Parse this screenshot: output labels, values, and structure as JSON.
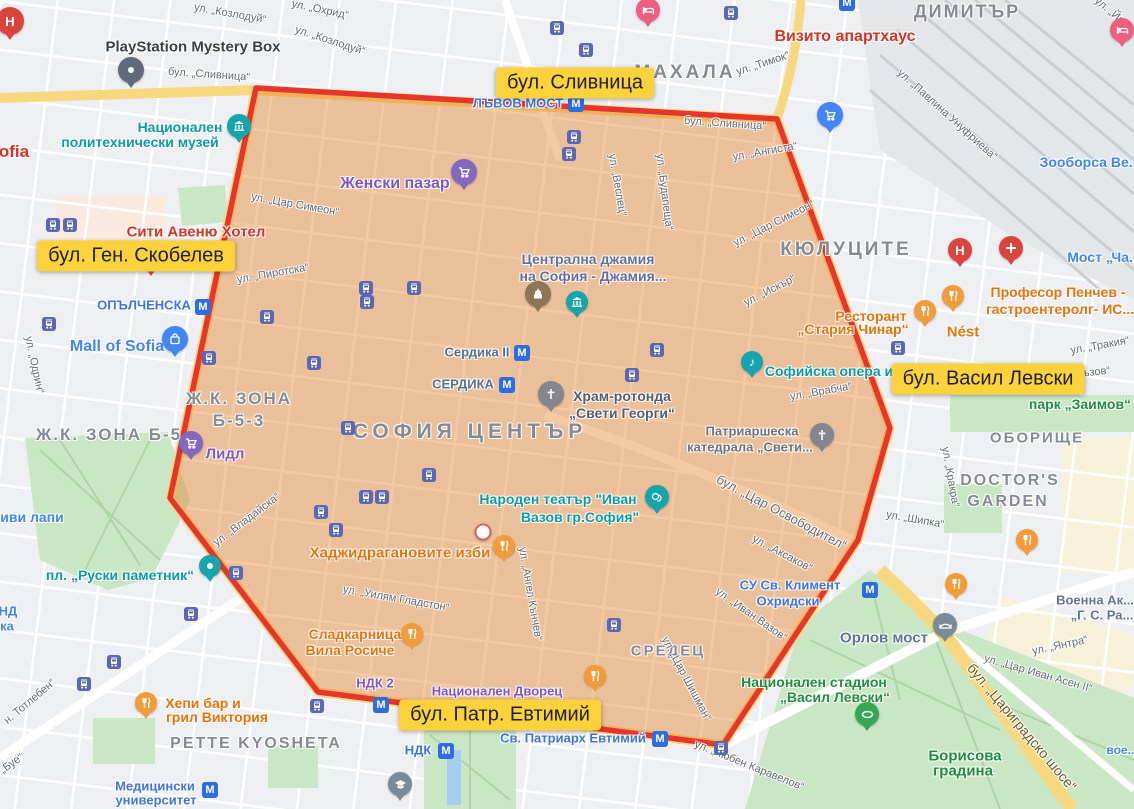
{
  "map": {
    "width": 1134,
    "height": 809
  },
  "colors": {
    "base": "#edeff2",
    "road_white": "#ffffff",
    "road_yellow": "#f8d87f",
    "park": "#c9e7c4",
    "park_path": "#aed3a8",
    "railway_bg": "#e4e7ea",
    "railway_line": "#c9ced4",
    "zone_fill": "#e67e22",
    "zone_fill_opacity": 0.42,
    "zone_stroke": "#e5352c",
    "highlight_bg": "#fbd23c",
    "teal": "#0d9aa3",
    "transit_blue": "#3f74e0",
    "poi_blue": "#4285f4",
    "purple": "#7e57c2",
    "mosque_text": "#646e9c",
    "orange_food": "#e8710a",
    "red_poi": "#d93025",
    "green_park_text": "#1e8e3e",
    "slate": "#56718f",
    "gray_dark": "#3c4043",
    "civic": "#5c7793",
    "street_gray": "#646b76",
    "area_gray": "#848b94",
    "sosse_brown": "#6d5a28"
  },
  "zone_polygon": {
    "points": [
      [
        256,
        88
      ],
      [
        777,
        119
      ],
      [
        890,
        428
      ],
      [
        858,
        540
      ],
      [
        723,
        745
      ],
      [
        318,
        692
      ],
      [
        170,
        498
      ]
    ]
  },
  "overlay_labels": [
    {
      "text": "бул. Сливница",
      "x": 575,
      "y": 83
    },
    {
      "text": "бул. Ген. Скобелев",
      "x": 136,
      "y": 256
    },
    {
      "text": "бул. Васил Левски",
      "x": 988,
      "y": 379
    },
    {
      "text": "бул. Патр. Евтимий",
      "x": 500,
      "y": 715
    }
  ],
  "area_labels": [
    {
      "text": "МАХАЛА",
      "x": 685,
      "y": 73,
      "size": 19,
      "ls": 3
    },
    {
      "text": "ДИМИТЪР",
      "x": 967,
      "y": 12,
      "size": 18,
      "ls": 2
    },
    {
      "text": "КЮЛУЦИТЕ",
      "x": 846,
      "y": 250,
      "size": 19,
      "ls": 3
    },
    {
      "text": "СОФИЯ ЦЕНТЪР",
      "x": 470,
      "y": 432,
      "size": 21,
      "ls": 5
    },
    {
      "text": "Ж.К. ЗОНА Б-5",
      "x": 109,
      "y": 435,
      "size": 17,
      "ls": 2
    },
    {
      "text": "Ж.К. ЗОНА",
      "x": 239,
      "y": 399,
      "size": 17,
      "ls": 2
    },
    {
      "text": "Б-5-3",
      "x": 239,
      "y": 421,
      "size": 17,
      "ls": 2
    },
    {
      "text": "ОБОРИЩЕ",
      "x": 1037,
      "y": 438,
      "size": 15,
      "ls": 2
    },
    {
      "text": "DOCTOR'S",
      "x": 1010,
      "y": 481,
      "size": 16,
      "ls": 2
    },
    {
      "text": "GARDEN",
      "x": 1008,
      "y": 502,
      "size": 16,
      "ls": 2
    },
    {
      "text": "PETTE KYOSHETA",
      "x": 256,
      "y": 744,
      "size": 16,
      "ls": 2
    },
    {
      "text": "СРЕДЕЦ",
      "x": 668,
      "y": 651,
      "size": 15,
      "ls": 2
    }
  ],
  "street_labels": [
    {
      "text": "ул. „Козлодуй“",
      "x": 230,
      "y": 14,
      "rot": 10
    },
    {
      "text": "ул. „Охрид“",
      "x": 320,
      "y": 10,
      "rot": 12
    },
    {
      "text": "ул. „Козлодуй“",
      "x": 330,
      "y": 41,
      "rot": 18
    },
    {
      "text": "бул. „Сливница“",
      "x": 209,
      "y": 75,
      "rot": 4
    },
    {
      "text": "бул. „Сливница“",
      "x": 725,
      "y": 124,
      "rot": 4
    },
    {
      "text": "ул. „Тимок“",
      "x": 763,
      "y": 64,
      "rot": -18
    },
    {
      "text": "ул. „Ангиста“",
      "x": 765,
      "y": 152,
      "rot": -10
    },
    {
      "text": "ул. „Павлина Унуфриева“",
      "x": 947,
      "y": 115,
      "rot": 42
    },
    {
      "text": "ул. „Веслец“",
      "x": 617,
      "y": 185,
      "rot": 80
    },
    {
      "text": "ул. „Будапеща“",
      "x": 664,
      "y": 192,
      "rot": 83
    },
    {
      "text": "ул. „Цар Симеон“",
      "x": 295,
      "y": 205,
      "rot": 10
    },
    {
      "text": "ул. „Цар Симеон“",
      "x": 774,
      "y": 224,
      "rot": -27
    },
    {
      "text": "ул. „Искър“",
      "x": 770,
      "y": 291,
      "rot": -27
    },
    {
      "text": "ул. „Пиротска“",
      "x": 273,
      "y": 274,
      "rot": -10
    },
    {
      "text": "ул. „Одрин“",
      "x": 34,
      "y": 365,
      "rot": 78
    },
    {
      "text": "ул. „Владайска“",
      "x": 247,
      "y": 520,
      "rot": -37
    },
    {
      "text": "ул. „Уилям Гладстон“",
      "x": 396,
      "y": 599,
      "rot": 10
    },
    {
      "text": "ул. „Ангел Кънчев“",
      "x": 530,
      "y": 594,
      "rot": 80
    },
    {
      "text": "ул. „Цар Шишман“",
      "x": 686,
      "y": 679,
      "rot": 62
    },
    {
      "text": "ул. „Иван Вазов“",
      "x": 751,
      "y": 615,
      "rot": 35
    },
    {
      "text": "ул. „Аксаков“",
      "x": 782,
      "y": 554,
      "rot": 28
    },
    {
      "text": "бул. „Цар Освободител“",
      "x": 781,
      "y": 513,
      "rot": 28,
      "size": 13
    },
    {
      "text": "ул. „Врабча“",
      "x": 821,
      "y": 392,
      "rot": -10
    },
    {
      "text": "ул. „Тракия“",
      "x": 1100,
      "y": 346,
      "rot": -10
    },
    {
      "text": "акъзов“",
      "x": 1091,
      "y": 373,
      "rot": -6
    },
    {
      "text": "ул. „Кракра“",
      "x": 950,
      "y": 477,
      "rot": 80
    },
    {
      "text": "ул. „Шипка“",
      "x": 915,
      "y": 520,
      "rot": 10
    },
    {
      "text": "ул. „Янтра“",
      "x": 1060,
      "y": 646,
      "rot": -12
    },
    {
      "text": "ул. „Цар Иван Асен II“",
      "x": 1038,
      "y": 674,
      "rot": 16
    },
    {
      "text": "бул. „Цариградско шосе“",
      "x": 1022,
      "y": 727,
      "rot": 50,
      "size": 14,
      "color": "#6d5a28"
    },
    {
      "text": "ул. „Любен Каравелов“",
      "x": 749,
      "y": 766,
      "rot": 22
    },
    {
      "text": "н. Тотлебен“",
      "x": 30,
      "y": 702,
      "rot": -40
    },
    {
      "text": "„Буе“",
      "x": 12,
      "y": 764,
      "rot": -35
    },
    {
      "text": "ул. „Йо...",
      "x": 1113,
      "y": 14,
      "rot": 40
    }
  ],
  "poi_labels": [
    {
      "text": "PlayStation Mystery Box",
      "x": 193,
      "y": 47,
      "color": "#3c4043",
      "size": 15
    },
    {
      "text": "ofia",
      "x": 14,
      "y": 152,
      "color": "#d93025",
      "size": 17
    },
    {
      "text": "Национален",
      "x": 180,
      "y": 127,
      "color": "#0d9aa3",
      "size": 14
    },
    {
      "text": "политехнически музей",
      "x": 140,
      "y": 142,
      "color": "#0d9aa3",
      "size": 14
    },
    {
      "text": "Сити Авеню Хотел",
      "x": 196,
      "y": 232,
      "color": "#d93025",
      "size": 15
    },
    {
      "text": "Визито апартхаус",
      "x": 845,
      "y": 37,
      "color": "#d93025",
      "size": 16
    },
    {
      "text": "Зооборса Ве...",
      "x": 1090,
      "y": 162,
      "color": "#4285f4",
      "size": 14
    },
    {
      "text": "Мост „Ча...",
      "x": 1104,
      "y": 257,
      "color": "#4285f4",
      "size": 14
    },
    {
      "text": "ЛЪВОВ МОСТ",
      "x": 518,
      "y": 104,
      "color": "#3f74e0",
      "size": 13
    },
    {
      "text": "МАХАЛА",
      "x": -500,
      "y": -500,
      "color": "#848b94",
      "size": 1
    },
    {
      "text": "Женски пазар",
      "x": 395,
      "y": 184,
      "color": "#7e57c2",
      "size": 16
    },
    {
      "text": "Централна джамия",
      "x": 588,
      "y": 259,
      "color": "#646e9c",
      "size": 14
    },
    {
      "text": "на София - Джамия...",
      "x": 593,
      "y": 276,
      "color": "#646e9c",
      "size": 14
    },
    {
      "text": "ОПЪЛЧЕНСКА",
      "x": 144,
      "y": 306,
      "color": "#3f74e0",
      "size": 13
    },
    {
      "text": "Mall of Sofia",
      "x": 117,
      "y": 347,
      "color": "#4285f4",
      "size": 16
    },
    {
      "text": "иви лапи",
      "x": 32,
      "y": 517,
      "color": "#4285f4",
      "size": 14
    },
    {
      "text": "Сердика II",
      "x": 477,
      "y": 353,
      "color": "#56718f",
      "size": 13
    },
    {
      "text": "СЕРДИКА",
      "x": 463,
      "y": 385,
      "color": "#56718f",
      "size": 13
    },
    {
      "text": "Храм-ротонда",
      "x": 622,
      "y": 396,
      "color": "#565d6d",
      "size": 14
    },
    {
      "text": "„Свети Георги“",
      "x": 622,
      "y": 413,
      "color": "#565d6d",
      "size": 14
    },
    {
      "text": "Патриаршеска",
      "x": 752,
      "y": 432,
      "color": "#6e7276",
      "size": 13
    },
    {
      "text": "катедрала „Свети...",
      "x": 750,
      "y": 448,
      "color": "#6e7276",
      "size": 13
    },
    {
      "text": "Софийска опера и ба...",
      "x": 845,
      "y": 371,
      "color": "#0d9aa3",
      "size": 14
    },
    {
      "text": "Ресторант",
      "x": 871,
      "y": 316,
      "color": "#e8710a",
      "size": 14
    },
    {
      "text": "„Стария Чинар“",
      "x": 853,
      "y": 329,
      "color": "#e8710a",
      "size": 14
    },
    {
      "text": "Nést",
      "x": 963,
      "y": 332,
      "color": "#e8710a",
      "size": 15
    },
    {
      "text": "Професор Пенчев -",
      "x": 1058,
      "y": 292,
      "color": "#e8710a",
      "size": 14
    },
    {
      "text": "гастроентеролг- ИС...",
      "x": 1060,
      "y": 309,
      "color": "#e8710a",
      "size": 14
    },
    {
      "text": "парк „Заимов“",
      "x": 1080,
      "y": 404,
      "color": "#1e8e3e",
      "size": 14
    },
    {
      "text": "Народен театър \"Иван",
      "x": 558,
      "y": 499,
      "color": "#0d9aa3",
      "size": 14
    },
    {
      "text": "Вазов гр.София\"",
      "x": 580,
      "y": 517,
      "color": "#0d9aa3",
      "size": 14
    },
    {
      "text": "Хаджидрагановите изби",
      "x": 400,
      "y": 553,
      "color": "#e8710a",
      "size": 15
    },
    {
      "text": "Лидл",
      "x": 225,
      "y": 454,
      "color": "#7e57c2",
      "size": 15
    },
    {
      "text": "пл. „Руски паметник“",
      "x": 120,
      "y": 575,
      "color": "#0d9aa3",
      "size": 14
    },
    {
      "text": "СУ Св. Климент",
      "x": 790,
      "y": 586,
      "color": "#3f74e0",
      "size": 13
    },
    {
      "text": "Охридски",
      "x": 788,
      "y": 602,
      "color": "#3f74e0",
      "size": 13
    },
    {
      "text": "Орлов мост",
      "x": 884,
      "y": 638,
      "color": "#5c7793",
      "size": 15
    },
    {
      "text": "Военна Ак...",
      "x": 1095,
      "y": 601,
      "color": "#5c7793",
      "size": 13
    },
    {
      "text": "„Г. С. Ра...",
      "x": 1102,
      "y": 616,
      "color": "#5c7793",
      "size": 13
    },
    {
      "text": "Национален стадион",
      "x": 814,
      "y": 682,
      "color": "#1e8e3e",
      "size": 14
    },
    {
      "text": "„Васил Левски“",
      "x": 835,
      "y": 697,
      "color": "#1e8e3e",
      "size": 14
    },
    {
      "text": "Борисова",
      "x": 965,
      "y": 756,
      "color": "#1e8e3e",
      "size": 15
    },
    {
      "text": "градина",
      "x": 963,
      "y": 771,
      "color": "#1e8e3e",
      "size": 15
    },
    {
      "text": "Сладкарница",
      "x": 355,
      "y": 634,
      "color": "#e8710a",
      "size": 14
    },
    {
      "text": "Вила Росиче",
      "x": 350,
      "y": 650,
      "color": "#e8710a",
      "size": 14
    },
    {
      "text": "НДК 2",
      "x": 375,
      "y": 684,
      "color": "#7e57c2",
      "size": 13
    },
    {
      "text": "Национален Дворец",
      "x": 497,
      "y": 692,
      "color": "#7e57c2",
      "size": 13
    },
    {
      "text": "НДК",
      "x": 418,
      "y": 751,
      "color": "#3f74e0",
      "size": 13
    },
    {
      "text": "Св. Патриарх Евтимий",
      "x": 573,
      "y": 739,
      "color": "#3f74e0",
      "size": 13
    },
    {
      "text": "СРЕДЕЦ",
      "x": -500,
      "y": -500,
      "color": "#848b94",
      "size": 1
    },
    {
      "text": "Хепи бар и",
      "x": 203,
      "y": 703,
      "color": "#e8710a",
      "size": 14
    },
    {
      "text": "грил Виктория",
      "x": 217,
      "y": 717,
      "color": "#e8710a",
      "size": 14
    },
    {
      "text": "Медицински",
      "x": 155,
      "y": 787,
      "color": "#3f74e0",
      "size": 13
    },
    {
      "text": "университет",
      "x": 156,
      "y": 801,
      "color": "#3f74e0",
      "size": 13
    },
    {
      "text": "НД",
      "x": 8,
      "y": 612,
      "color": "#4285f4",
      "size": 13
    },
    {
      "text": "ка",
      "x": 7,
      "y": 627,
      "color": "#4285f4",
      "size": 13
    },
    {
      "text": "вое...",
      "x": 1122,
      "y": 751,
      "color": "#4285f4",
      "size": 12
    }
  ],
  "metro_icons": [
    {
      "x": 576,
      "y": 104
    },
    {
      "x": 203,
      "y": 307
    },
    {
      "x": 522,
      "y": 353
    },
    {
      "x": 507,
      "y": 385
    },
    {
      "x": 381,
      "y": 705
    },
    {
      "x": 446,
      "y": 751
    },
    {
      "x": 660,
      "y": 739
    },
    {
      "x": 870,
      "y": 590
    },
    {
      "x": 210,
      "y": 790
    },
    {
      "x": 847,
      "y": 3
    }
  ],
  "tram_icons": [
    {
      "x": 53,
      "y": 225
    },
    {
      "x": 70,
      "y": 225
    },
    {
      "x": 49,
      "y": 324
    },
    {
      "x": 267,
      "y": 317
    },
    {
      "x": 209,
      "y": 358
    },
    {
      "x": 314,
      "y": 363
    },
    {
      "x": 557,
      "y": 28
    },
    {
      "x": 586,
      "y": 50
    },
    {
      "x": 731,
      "y": 13
    },
    {
      "x": 574,
      "y": 137
    },
    {
      "x": 569,
      "y": 154
    },
    {
      "x": 366,
      "y": 288
    },
    {
      "x": 367,
      "y": 302
    },
    {
      "x": 414,
      "y": 288
    },
    {
      "x": 657,
      "y": 350
    },
    {
      "x": 632,
      "y": 375
    },
    {
      "x": 429,
      "y": 475
    },
    {
      "x": 348,
      "y": 428
    },
    {
      "x": 366,
      "y": 497
    },
    {
      "x": 382,
      "y": 497
    },
    {
      "x": 321,
      "y": 512
    },
    {
      "x": 336,
      "y": 530
    },
    {
      "x": 236,
      "y": 573
    },
    {
      "x": 191,
      "y": 614
    },
    {
      "x": 114,
      "y": 662
    },
    {
      "x": 84,
      "y": 684
    },
    {
      "x": 317,
      "y": 706
    },
    {
      "x": 614,
      "y": 625
    },
    {
      "x": 721,
      "y": 748
    },
    {
      "x": 898,
      "y": 348
    }
  ],
  "pins": [
    {
      "icon": "hospital-h",
      "x": 10,
      "y": 40,
      "color": "#d9453c",
      "size": 28
    },
    {
      "icon": "generic",
      "x": 131,
      "y": 88,
      "color": "#5f6b7a",
      "size": 26
    },
    {
      "icon": "museum",
      "x": 239,
      "y": 143,
      "color": "#17a5ad",
      "size": 24
    },
    {
      "icon": "generic",
      "x": 151,
      "y": 276,
      "color": "#d9453c",
      "size": 18
    },
    {
      "icon": "bag",
      "x": 175,
      "y": 357,
      "color": "#4285f4",
      "size": 26
    },
    {
      "icon": "cart",
      "x": 464,
      "y": 190,
      "color": "#8268be",
      "size": 26
    },
    {
      "icon": "cart",
      "x": 191,
      "y": 460,
      "color": "#8268be",
      "size": 24
    },
    {
      "icon": "cart",
      "x": 830,
      "y": 133,
      "color": "#4285f4",
      "size": 26
    },
    {
      "icon": "bed",
      "x": 648,
      "y": 27,
      "color": "#ec5f80",
      "size": 24
    },
    {
      "icon": "bed",
      "x": 1122,
      "y": 47,
      "color": "#ec5f80",
      "size": 24
    },
    {
      "icon": "mosque",
      "x": 538,
      "y": 312,
      "color": "#8d7558",
      "size": 26
    },
    {
      "icon": "museum",
      "x": 577,
      "y": 318,
      "color": "#17a5ad",
      "size": 22
    },
    {
      "icon": "church",
      "x": 551,
      "y": 412,
      "color": "#84868f",
      "size": 26
    },
    {
      "icon": "church",
      "x": 822,
      "y": 452,
      "color": "#84868f",
      "size": 24
    },
    {
      "icon": "music",
      "x": 752,
      "y": 378,
      "color": "#17a5ad",
      "size": 22
    },
    {
      "icon": "theater",
      "x": 657,
      "y": 514,
      "color": "#17a5ad",
      "size": 24
    },
    {
      "icon": "generic",
      "x": 210,
      "y": 582,
      "color": "#17a5ad",
      "size": 22
    },
    {
      "icon": "fork",
      "x": 925,
      "y": 327,
      "color": "#f29b38",
      "size": 22
    },
    {
      "icon": "fork",
      "x": 953,
      "y": 312,
      "color": "#f29b38",
      "size": 22
    },
    {
      "icon": "fork",
      "x": 504,
      "y": 562,
      "color": "#f29b38",
      "size": 22
    },
    {
      "icon": "fork",
      "x": 412,
      "y": 650,
      "color": "#f29b38",
      "size": 22
    },
    {
      "icon": "fork",
      "x": 146,
      "y": 719,
      "color": "#f29b38",
      "size": 22
    },
    {
      "icon": "fork",
      "x": 595,
      "y": 692,
      "color": "#f29b38",
      "size": 22
    },
    {
      "icon": "fork",
      "x": 956,
      "y": 600,
      "color": "#f29b38",
      "size": 22
    },
    {
      "icon": "fork",
      "x": 1027,
      "y": 556,
      "color": "#f29b38",
      "size": 22
    },
    {
      "icon": "hospital-h",
      "x": 960,
      "y": 267,
      "color": "#d9453c",
      "size": 24
    },
    {
      "icon": "hospital-cross",
      "x": 1011,
      "y": 265,
      "color": "#d9453c",
      "size": 24
    },
    {
      "icon": "bridge",
      "x": 945,
      "y": 642,
      "color": "#7a8a99",
      "size": 24
    },
    {
      "icon": "stadium",
      "x": 867,
      "y": 731,
      "color": "#34a853",
      "size": 24
    },
    {
      "icon": "grad-cap",
      "x": 400,
      "y": 801,
      "color": "#7a8a99",
      "size": 24
    }
  ],
  "white_dot": {
    "x": 483,
    "y": 532
  }
}
